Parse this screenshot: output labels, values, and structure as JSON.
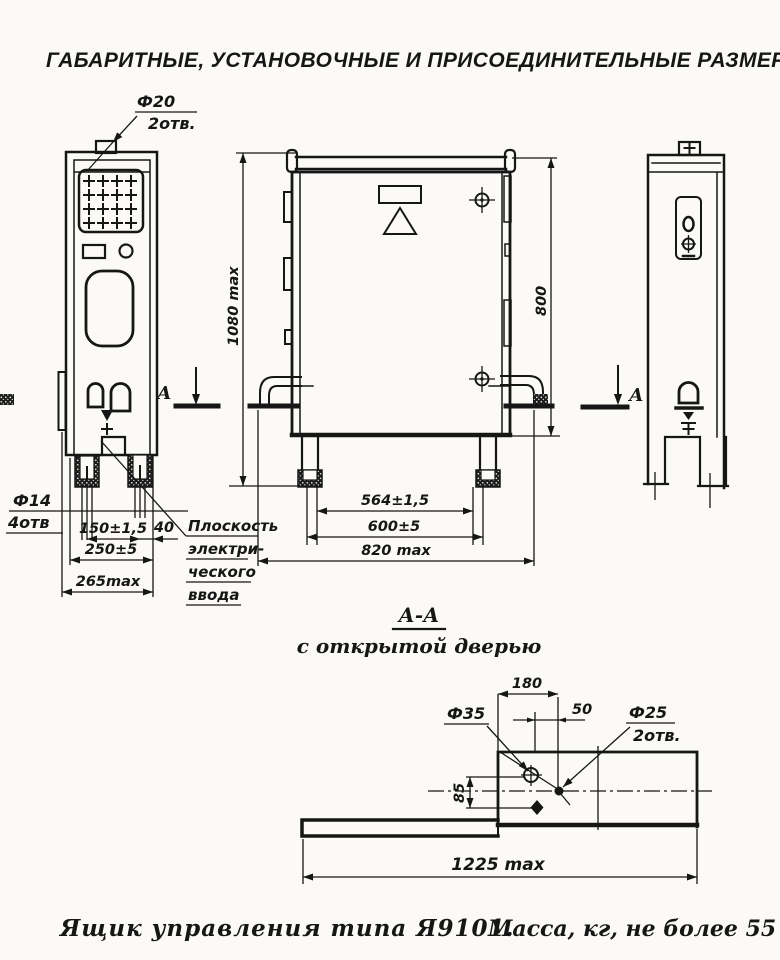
{
  "title": "ГАБАРИТНЫЕ, УСТАНОВОЧНЫЕ И ПРИСОЕДИНИТЕЛЬНЫЕ РАЗМЕРЫ,",
  "colors": {
    "ink": "#161616",
    "paper": "#fbfaf6"
  },
  "side_view_left": {
    "callout_top": {
      "dia": "Ф20",
      "count": "2отв."
    },
    "callout_bottom": {
      "dia": "Ф14",
      "count": "4отв"
    },
    "dims": {
      "d150": "150±1,5",
      "d40": "40",
      "d250": "250±5",
      "d265": "265max"
    },
    "plane_note": [
      "Плоскость",
      "электри-",
      "ческого",
      "ввода"
    ]
  },
  "front_view": {
    "dims": {
      "height": "1080 max",
      "door": "800",
      "d564": "564±1,5",
      "d600": "600±5",
      "d820": "820 max"
    }
  },
  "section_marker": {
    "letter": "А"
  },
  "section_view": {
    "title": "А-А",
    "subtitle": "с открытой дверью",
    "dims": {
      "d180": "180",
      "d50": "50",
      "d85": "85",
      "d1225": "1225 max"
    },
    "callout_35": {
      "dia": "Ф35"
    },
    "callout_25": {
      "dia": "Ф25",
      "count": "2отв."
    }
  },
  "caption": {
    "name": "Ящик управления типа Я9101.",
    "mass": "Масса, кг, не более 55"
  }
}
